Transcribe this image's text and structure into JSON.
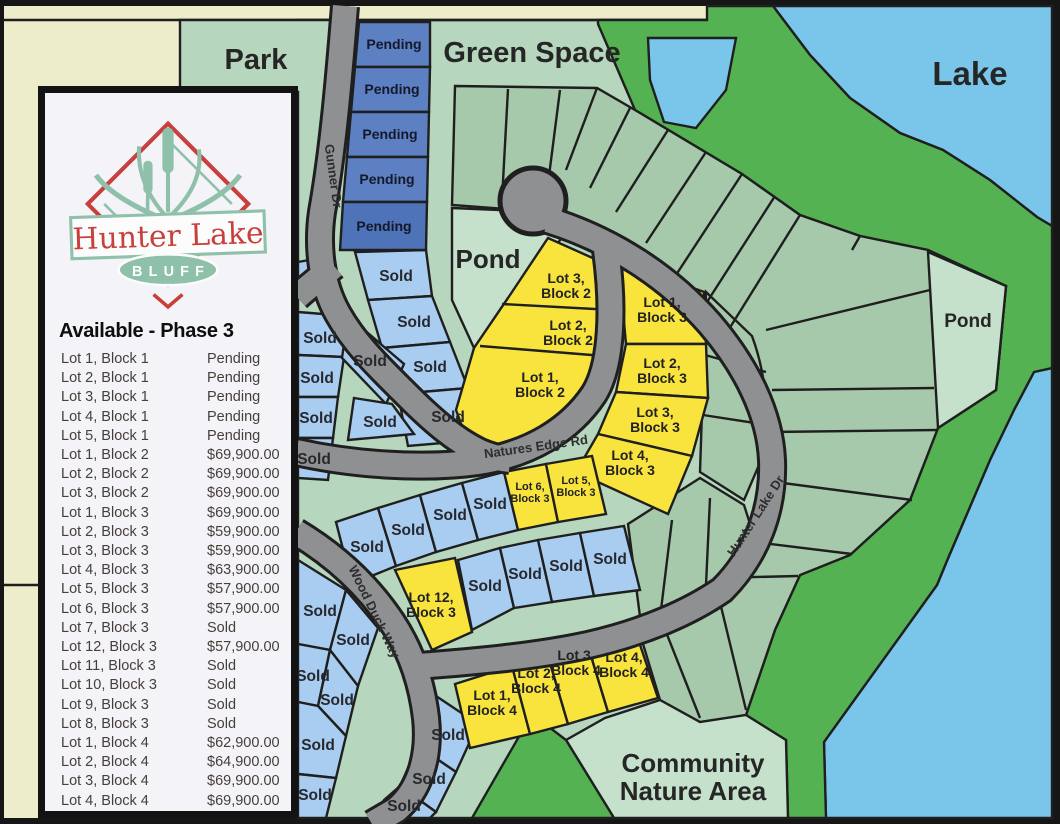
{
  "panel": {
    "logo": {
      "title": "Hunter Lake",
      "subtitle": "BLUFF"
    },
    "heading": "Available - Phase 3",
    "listings": [
      {
        "lot": "Lot 1, Block 1",
        "price": "Pending"
      },
      {
        "lot": "Lot 2, Block 1",
        "price": "Pending"
      },
      {
        "lot": "Lot 3, Block 1",
        "price": "Pending"
      },
      {
        "lot": "Lot 4, Block 1",
        "price": "Pending"
      },
      {
        "lot": "Lot 5, Block 1",
        "price": "Pending"
      },
      {
        "lot": "Lot 1, Block 2",
        "price": "$69,900.00"
      },
      {
        "lot": "Lot 2, Block 2",
        "price": "$69,900.00"
      },
      {
        "lot": "Lot 3, Block 2",
        "price": "$69,900.00"
      },
      {
        "lot": "Lot 1, Block 3",
        "price": "$69,900.00"
      },
      {
        "lot": "Lot 2, Block 3",
        "price": "$59,900.00"
      },
      {
        "lot": "Lot 3, Block 3",
        "price": "$59,900.00"
      },
      {
        "lot": "Lot 4, Block 3",
        "price": "$63,900.00"
      },
      {
        "lot": "Lot 5, Block 3",
        "price": "$57,900.00"
      },
      {
        "lot": "Lot 6, Block 3",
        "price": "$57,900.00"
      },
      {
        "lot": "Lot 7, Block 3",
        "price": "Sold"
      },
      {
        "lot": "Lot 12, Block 3",
        "price": "$57,900.00"
      },
      {
        "lot": "Lot 11, Block 3",
        "price": "Sold"
      },
      {
        "lot": "Lot 10, Block 3",
        "price": "Sold"
      },
      {
        "lot": "Lot 9, Block 3",
        "price": "Sold"
      },
      {
        "lot": "Lot 8, Block 3",
        "price": "Sold"
      },
      {
        "lot": "Lot 1, Block 4",
        "price": "$62,900.00"
      },
      {
        "lot": "Lot 2, Block 4",
        "price": "$64,900.00"
      },
      {
        "lot": "Lot 3, Block 4",
        "price": "$69,900.00"
      },
      {
        "lot": "Lot 4, Block 4",
        "price": "$69,900.00"
      }
    ]
  },
  "map": {
    "areas": {
      "park": "Park",
      "green_space": "Green Space",
      "lake": "Lake",
      "pond": "Pond",
      "community_line1": "Community",
      "community_line2": "Nature Area"
    },
    "roads": {
      "gunner": "Gunner Dr",
      "natures_edge": "Natures Edge Rd",
      "wood_duck": "Wood Duck Way",
      "hunter_lake": "Hunter Lake Dr"
    },
    "status_labels": {
      "pending": "Pending",
      "sold": "Sold"
    },
    "available_lots": {
      "b2l3": {
        "line1": "Lot 3,",
        "line2": "Block 2"
      },
      "b2l2": {
        "line1": "Lot 2,",
        "line2": "Block 2"
      },
      "b2l1": {
        "line1": "Lot 1,",
        "line2": "Block 2"
      },
      "b3l1": {
        "line1": "Lot 1,",
        "line2": "Block 3"
      },
      "b3l2": {
        "line1": "Lot 2,",
        "line2": "Block 3"
      },
      "b3l3": {
        "line1": "Lot 3,",
        "line2": "Block 3"
      },
      "b3l4": {
        "line1": "Lot 4,",
        "line2": "Block 3"
      },
      "b3l5": {
        "line1": "Lot 5,",
        "line2": "Block 3"
      },
      "b3l6": {
        "line1": "Lot 6,",
        "line2": "Block 3"
      },
      "b3l12": {
        "line1": "Lot 12,",
        "line2": "Block 3"
      },
      "b4l1": {
        "line1": "Lot 1,",
        "line2": "Block 4"
      },
      "b4l2": {
        "line1": "Lot 2,",
        "line2": "Block 4"
      },
      "b4l3": {
        "line1": "Lot 3,",
        "line2": "Block 4"
      },
      "b4l4": {
        "line1": "Lot 4,",
        "line2": "Block 4"
      }
    },
    "colors": {
      "available": "#f8e43c",
      "sold": "#a9cdf0",
      "pending": "#5d80c3",
      "lake": "#7ac6ea",
      "greenbelt": "#55b252",
      "road": "#8f9092",
      "open_space": "#b6d6bd",
      "lots_green": "#a6c9ab",
      "pond": "#c5e0cb"
    }
  }
}
